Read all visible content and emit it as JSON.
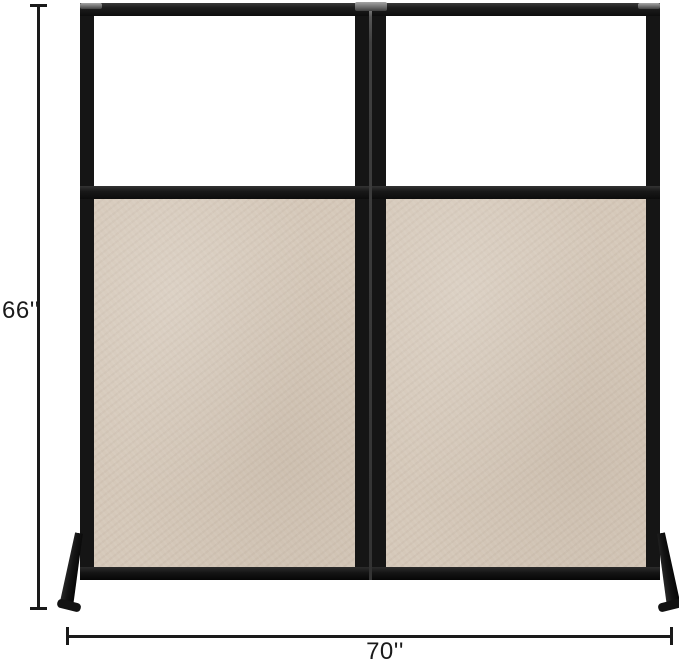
{
  "dimensions": {
    "height_label": "66''",
    "width_label": "70''"
  },
  "product": {
    "panel_count": 2,
    "panel_sections": [
      "clear-acrylic-window",
      "fabric-privacy-panel"
    ],
    "frame_style": "black-folding-frame-with-angled-feet"
  },
  "colors": {
    "frame": "#151515",
    "fabric": "#d5c8b9",
    "window": "#ffffff",
    "hinge": "#6e6e6e",
    "dimension": "#1a1a1a",
    "background": "#ffffff"
  }
}
